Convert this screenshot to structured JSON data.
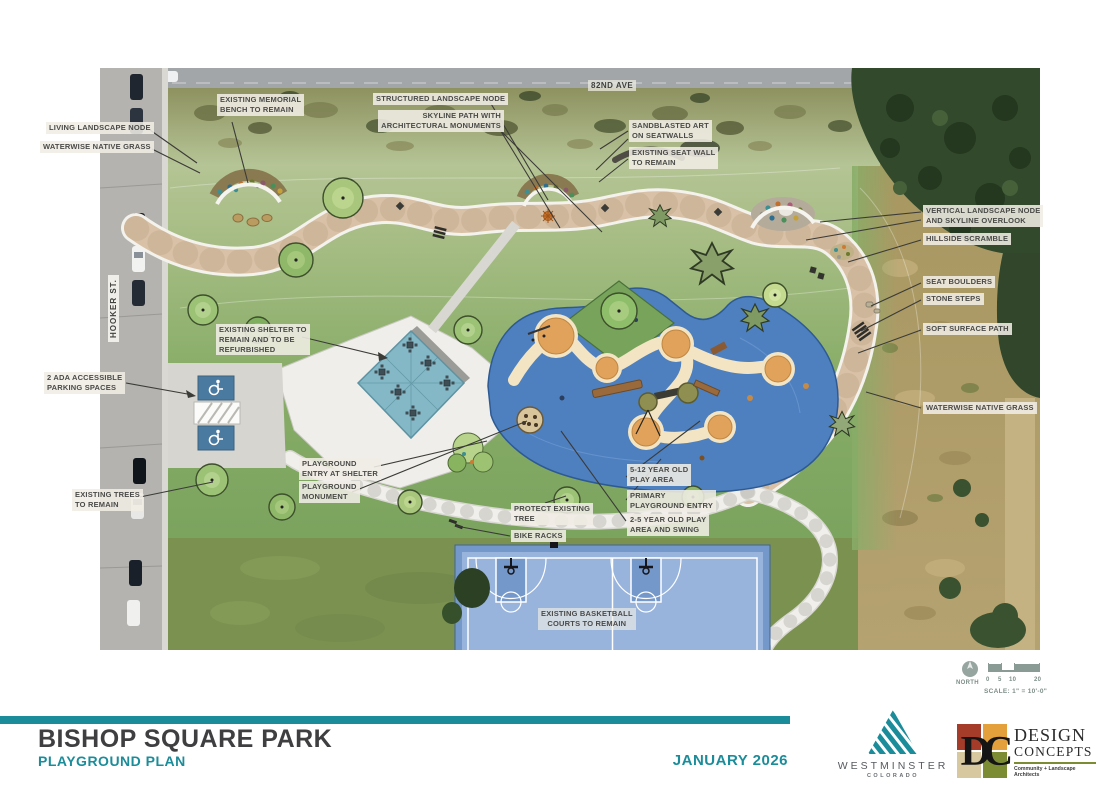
{
  "sheet": {
    "title": "BISHOP SQUARE PARK",
    "subtitle": "PLAYGROUND PLAN",
    "date": "JANUARY 2026"
  },
  "plan": {
    "streets": {
      "top": "82ND AVE",
      "left": "HOOKER ST."
    },
    "callouts": {
      "living_landscape_node": "LIVING LANDSCAPE NODE",
      "waterwise_grass_left": "WATERWISE NATIVE GRASS",
      "memorial_bench": "EXISTING MEMORIAL\nBENCH TO REMAIN",
      "structured_landscape_node": "STRUCTURED LANDSCAPE NODE",
      "skyline_path": "SKYLINE PATH WITH\nARCHITECTURAL MONUMENTS",
      "sandblasted_art": "SANDBLASTED ART\nON SEATWALLS",
      "existing_seat_wall": "EXISTING SEAT WALL\nTO REMAIN",
      "vertical_landscape_node": "VERTICAL LANDSCAPE NODE\nAND SKYLINE OVERLOOK",
      "hillside_scramble": "HILLSIDE SCRAMBLE",
      "seat_boulders": "SEAT BOULDERS",
      "stone_steps": "STONE STEPS",
      "soft_surface_path": "SOFT SURFACE PATH",
      "waterwise_grass_right": "WATERWISE NATIVE GRASS",
      "ada_parking": "2 ADA ACCESSIBLE\nPARKING SPACES",
      "existing_trees": "EXISTING TREES\nTO REMAIN",
      "existing_shelter": "EXISTING SHELTER TO\nREMAIN AND TO BE\nREFURBISHED",
      "playground_entry_shelter": "PLAYGROUND\nENTRY AT SHELTER",
      "playground_monument": "PLAYGROUND\nMONUMENT",
      "protect_tree": "PROTECT EXISTING\nTREE",
      "bike_racks": "BIKE RACKS",
      "play_area_5_12": "5-12 YEAR OLD\nPLAY AREA",
      "primary_entry": "PRIMARY\nPLAYGROUND ENTRY",
      "play_area_2_5": "2-5 YEAR OLD PLAY\nAREA AND SWING",
      "basketball_courts": "EXISTING BASKETBALL\nCOURTS TO REMAIN"
    },
    "north": {
      "label": "NORTH"
    },
    "scale": {
      "ticks": [
        "0",
        "5",
        "10",
        "20"
      ],
      "text": "SCALE: 1\" = 10'-0\""
    }
  },
  "logos": {
    "westminster": {
      "name": "WESTMINSTER",
      "sub": "COLORADO"
    },
    "design_concepts": {
      "monogram": "DC",
      "line1": "DESIGN",
      "line2": "CONCEPTS",
      "tagline": "Community + Landscape Architects"
    }
  },
  "colors": {
    "accent_teal": "#1b8c99",
    "title_gray": "#3f3f41",
    "playground_blue": "#4e80c0",
    "path_tan": "#d8c1a6",
    "lawn_green": "#8cb06c"
  }
}
